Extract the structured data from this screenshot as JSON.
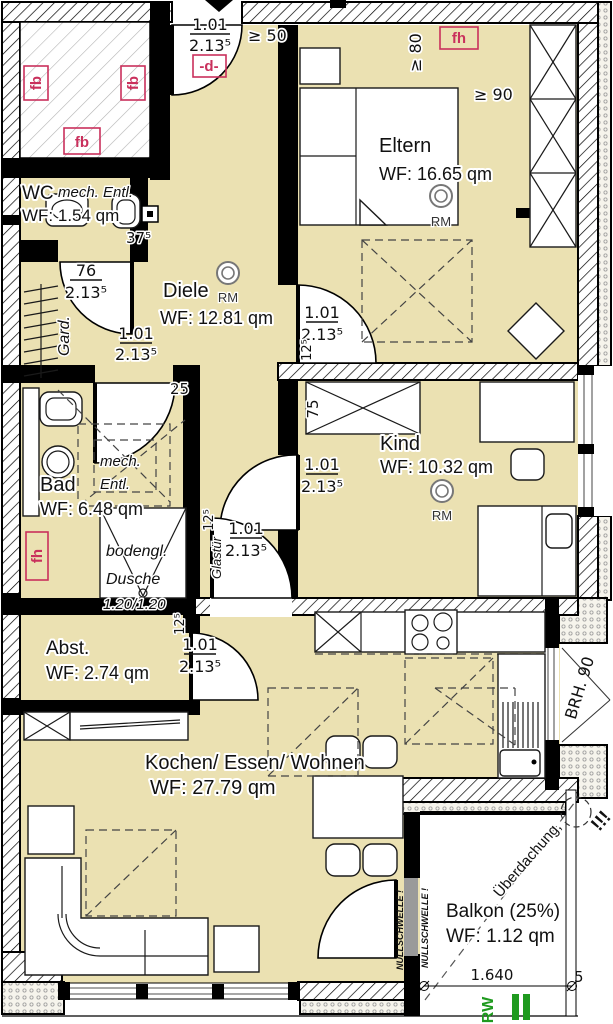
{
  "rooms": {
    "eltern": {
      "name": "Eltern",
      "area": "WF: 16.65 qm"
    },
    "kind": {
      "name": "Kind",
      "area": "WF: 10.32 qm"
    },
    "diele": {
      "name": "Diele",
      "area": "WF: 12.81 qm"
    },
    "bad": {
      "name": "Bad",
      "area": "WF: 6.48 qm"
    },
    "wc": {
      "name": "WC",
      "vent": "mech. Entl.",
      "area": "WF: 1.54 qm"
    },
    "abst": {
      "name": "Abst.",
      "area": "WF: 2.74 qm"
    },
    "wohnen": {
      "name": "Kochen/ Essen/ Wohnen",
      "area": "WF: 27.79 qm"
    },
    "balkon": {
      "name": "Balkon (25%)",
      "area": "WF: 1.12 qm"
    }
  },
  "doors": {
    "entry": {
      "w": "1.01",
      "h": "2.13⁵",
      "type": "-d-",
      "min": "≥ 50"
    },
    "wc": {
      "w": "76",
      "h": "2.13⁵"
    },
    "bad": {
      "w": "1.01",
      "h": "2.13⁵"
    },
    "eltern": {
      "w": "1.01",
      "h": "2.13⁵"
    },
    "kind": {
      "w": "1.01",
      "h": "2.13⁵"
    },
    "glas": {
      "w": "1.01",
      "h": "2.13⁵",
      "label": "Glastür"
    },
    "abst": {
      "w": "1.01",
      "h": "2.13⁵"
    }
  },
  "dims": {
    "wc_wall": "37⁵",
    "stub": "12⁵",
    "niche": "25",
    "wardrobe": "75",
    "min80": "≥ 80",
    "min90": "≥ 90",
    "brh": "BRH. 90",
    "balkon_width": "1.640",
    "balkon_extra": "5",
    "shower_size": "1.20/1.20"
  },
  "annotations": {
    "fb": "fb",
    "fh": "fh",
    "rm": "RM",
    "rw": "RW",
    "nullschwelle": "NULLSCHWELLE !",
    "ueberdachung": "Überdachung,",
    "attention": "!!!",
    "gard": "Gard.",
    "mech": "mech.",
    "entl": "Entl.",
    "bodengl": "bodengl.",
    "dusche": "Dusche"
  },
  "colors": {
    "floor": "#ebe1b2",
    "marker_red": "#c9305c",
    "green": "#1f9a1f",
    "wall": "#000000"
  }
}
